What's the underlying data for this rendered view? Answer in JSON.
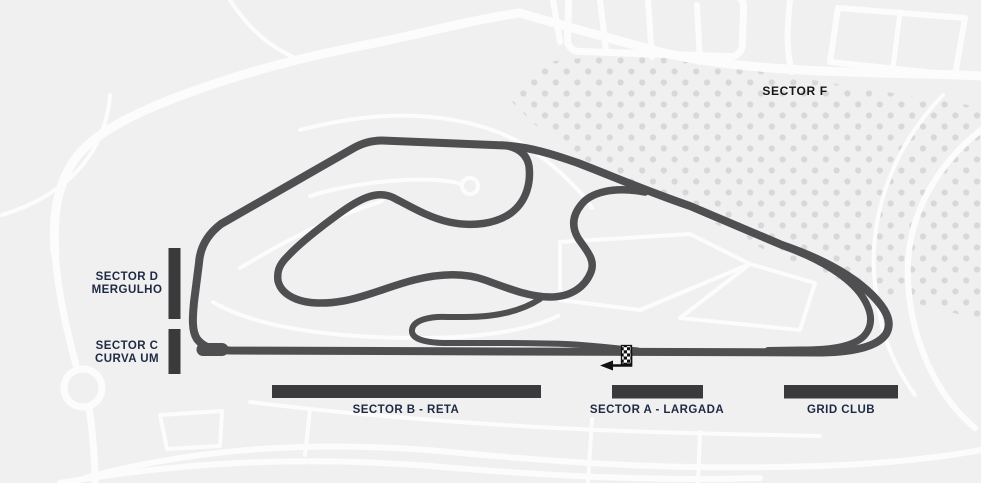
{
  "map": {
    "title": "race-circuit-sector-map",
    "circuit_style": "interlagos-style layout, anticlockwise (arrow points left at start line)",
    "colors": {
      "bg": "#f0f0f1",
      "track": "#4f4f51",
      "bar": "#3a3a3c",
      "navy": "#1e2a44",
      "dark": "#161616",
      "road": "#fcfcfc",
      "dots": "#d8d8d8"
    },
    "sectors": {
      "sector_d": {
        "line1": "SECTOR D",
        "line2": "MERGULHO"
      },
      "sector_c": {
        "line1": "SECTOR C",
        "line2": "CURVA UM"
      },
      "sector_b": {
        "label": "SECTOR B - RETA"
      },
      "sector_a": {
        "label": "SECTOR A - LARGADA"
      },
      "grid_club": {
        "label": "GRID CLUB"
      },
      "sector_f": {
        "label": "SECTOR F"
      }
    },
    "markers": {
      "start_finish": "checkered-flag",
      "direction": "left-arrow"
    }
  }
}
